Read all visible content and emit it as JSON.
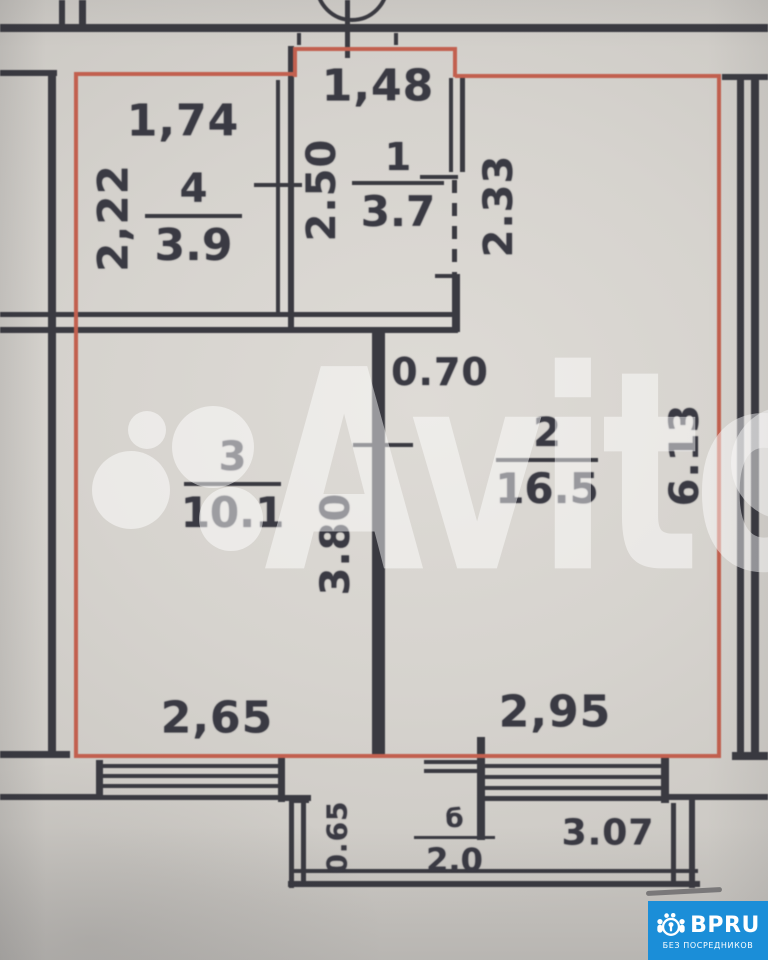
{
  "plan": {
    "rooms": [
      {
        "number": "4",
        "area": "3.9"
      },
      {
        "number": "1",
        "area": "3.7"
      },
      {
        "number": "3",
        "area": "10.1"
      },
      {
        "number": "2",
        "area": "16.5"
      },
      {
        "number": "б",
        "area": "2.0"
      }
    ],
    "dims": {
      "room4_width": "1,74",
      "room4_depth": "2,22",
      "room1_width": "1,48",
      "room1_depth": "2.50",
      "hall_opening": "2.33",
      "wall_stub": "0.70",
      "partition_length": "3.80",
      "room2_depth": "6.13",
      "room3_window": "2,65",
      "room2_window": "2,95",
      "balcony_length": "3.07",
      "balcony_depth": "0.65"
    }
  },
  "watermark": {
    "text": "Avito"
  },
  "logo": {
    "brand": "BPRU",
    "tagline": "БЕЗ ПОСРЕДНИКОВ"
  },
  "colors": {
    "boundary_red": "#c2604f",
    "wall_ink": "#3a3a41",
    "paper": "#d6d3ce",
    "logo_blue": "#1b8ed8"
  }
}
